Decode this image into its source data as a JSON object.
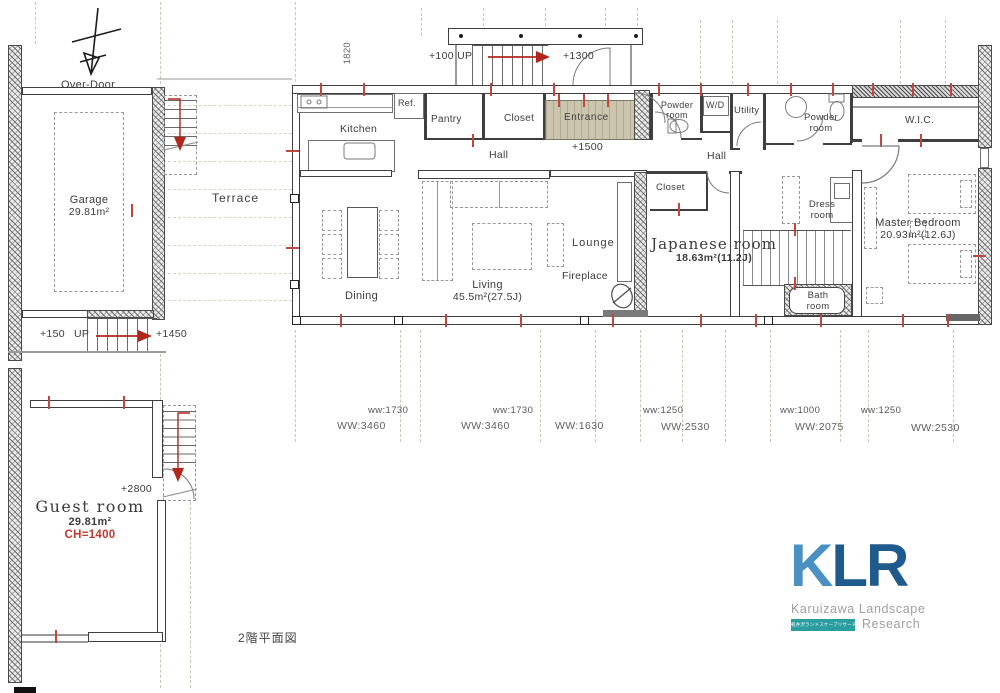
{
  "meta": {
    "plan_title": "2階平面図"
  },
  "annotations": {
    "over_door": "Over-Door",
    "stair_width": "1820"
  },
  "levels": {
    "garage_up": "+150",
    "garage_up_word": "UP",
    "garage_top": "+1450",
    "porch_up": "+100 UP",
    "porch_top": "+1300",
    "entrance": "+1500",
    "guest": "+2800"
  },
  "rooms": {
    "garage": {
      "name": "Garage",
      "area": "29.81m²"
    },
    "terrace": {
      "name": "Terrace"
    },
    "kitchen": {
      "name": "Kitchen"
    },
    "ref": {
      "name": "Ref."
    },
    "pantry": {
      "name": "Pantry"
    },
    "closet_hall": {
      "name": "Closet"
    },
    "entrance": {
      "name": "Entrance"
    },
    "hall_left": {
      "name": "Hall"
    },
    "hall_right": {
      "name": "Hall"
    },
    "powder1": {
      "name": "Powder room"
    },
    "wd": {
      "name": "W/D"
    },
    "utility": {
      "name": "Utility"
    },
    "powder2": {
      "name": "Powder room"
    },
    "wic": {
      "name": "W.I.C."
    },
    "dining": {
      "name": "Dining"
    },
    "living": {
      "name": "Living",
      "area": "45.5m²(27.5J)"
    },
    "lounge": {
      "name": "Lounge"
    },
    "fireplace": {
      "name": "Fireplace"
    },
    "japanese": {
      "name": "Japanese room",
      "area": "18.63m²(11.2J)"
    },
    "closet_jp": {
      "name": "Closet"
    },
    "dress": {
      "name": "Dress room"
    },
    "bath": {
      "name": "Bath room"
    },
    "master": {
      "name": "Master Bedroom",
      "area": "20.93m²(12.6J)"
    },
    "guest": {
      "name": "Guest room",
      "area": "29.81m²",
      "ceiling": "CH=1400"
    }
  },
  "dim_row": [
    {
      "ws": "ww:1730",
      "ww": "WW:3460"
    },
    {
      "ws": "ww:1730",
      "ww": "WW:3460"
    },
    {
      "ww": "WW:1630"
    },
    {
      "ws": "ww:1250",
      "ww": "WW:2530"
    },
    {
      "ws": "ww:1000",
      "ww": "WW:2075"
    },
    {
      "ws": "ww:1250",
      "ww": "WW:2530"
    }
  ],
  "logo": {
    "k": "K",
    "lr": "LR",
    "line1": "Karuizawa Landscape",
    "line2": "Research",
    "badge": "軽井沢ランドスケープリサーチ",
    "colors": {
      "k": "#4a90c2",
      "lr": "#1e5a8c",
      "text": "#9e9e9e",
      "badge_bg": "#2a9da0",
      "accent_red": "#c2463c"
    }
  }
}
